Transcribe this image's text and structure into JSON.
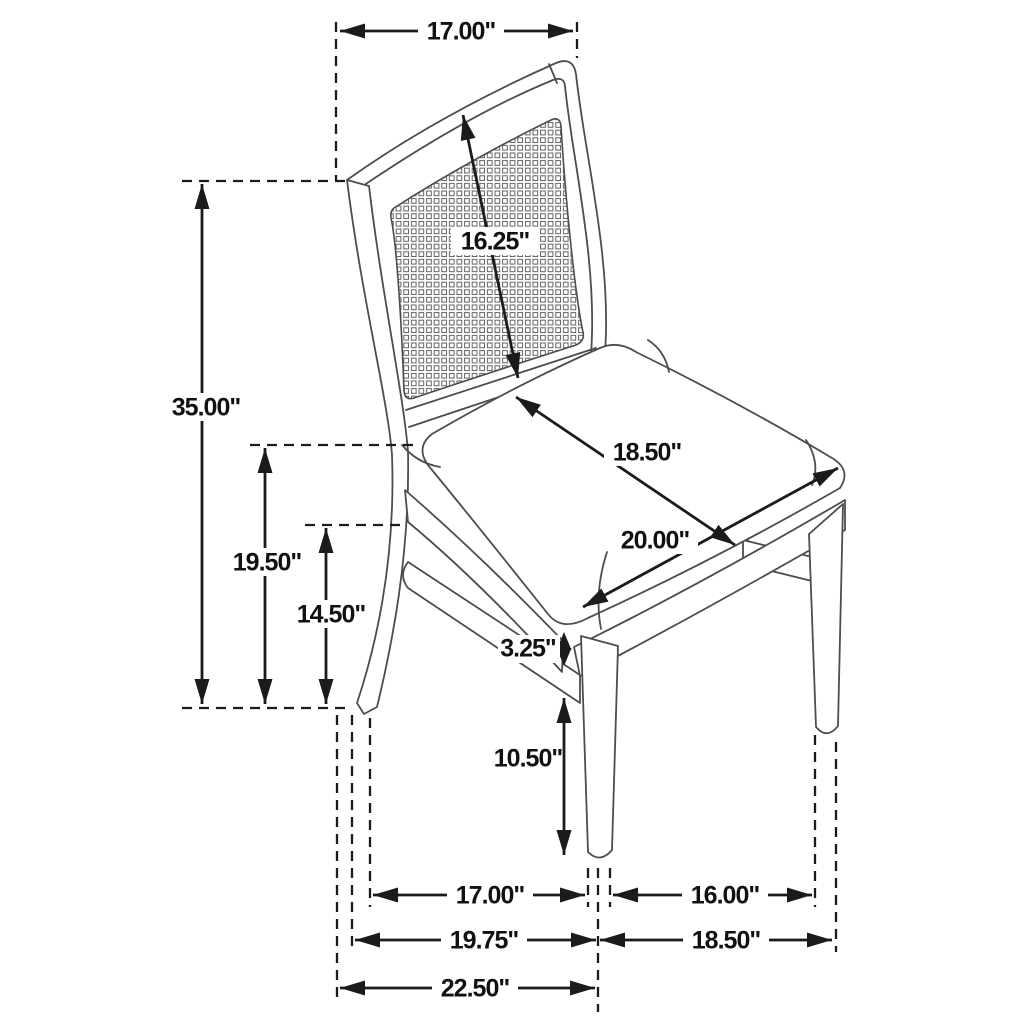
{
  "diagram": {
    "subject": "Side chair with cane back and upholstered seat — dimension drawing",
    "unit": "inches",
    "colors": {
      "canvas": "#ffffff",
      "chair_line": "#4d4d4d",
      "dimension_line": "#1b1b1b",
      "label_text": "#111111"
    },
    "dims": {
      "back_top_width": "17.00\"",
      "back_panel_height": "16.25\"",
      "overall_height": "35.00\"",
      "seat_height": "19.50\"",
      "apron_bottom_height": "14.50\"",
      "seat_depth": "18.50\"",
      "seat_width": "20.00\"",
      "apron_to_stretcher_gap": "3.25\"",
      "stretcher_to_floor": "10.50\"",
      "front_to_back_leg_span": "17.00\"",
      "front_leg_span": "16.00\"",
      "base_depth": "19.75\"",
      "base_width": "18.50\"",
      "overall_depth": "22.50\""
    }
  }
}
